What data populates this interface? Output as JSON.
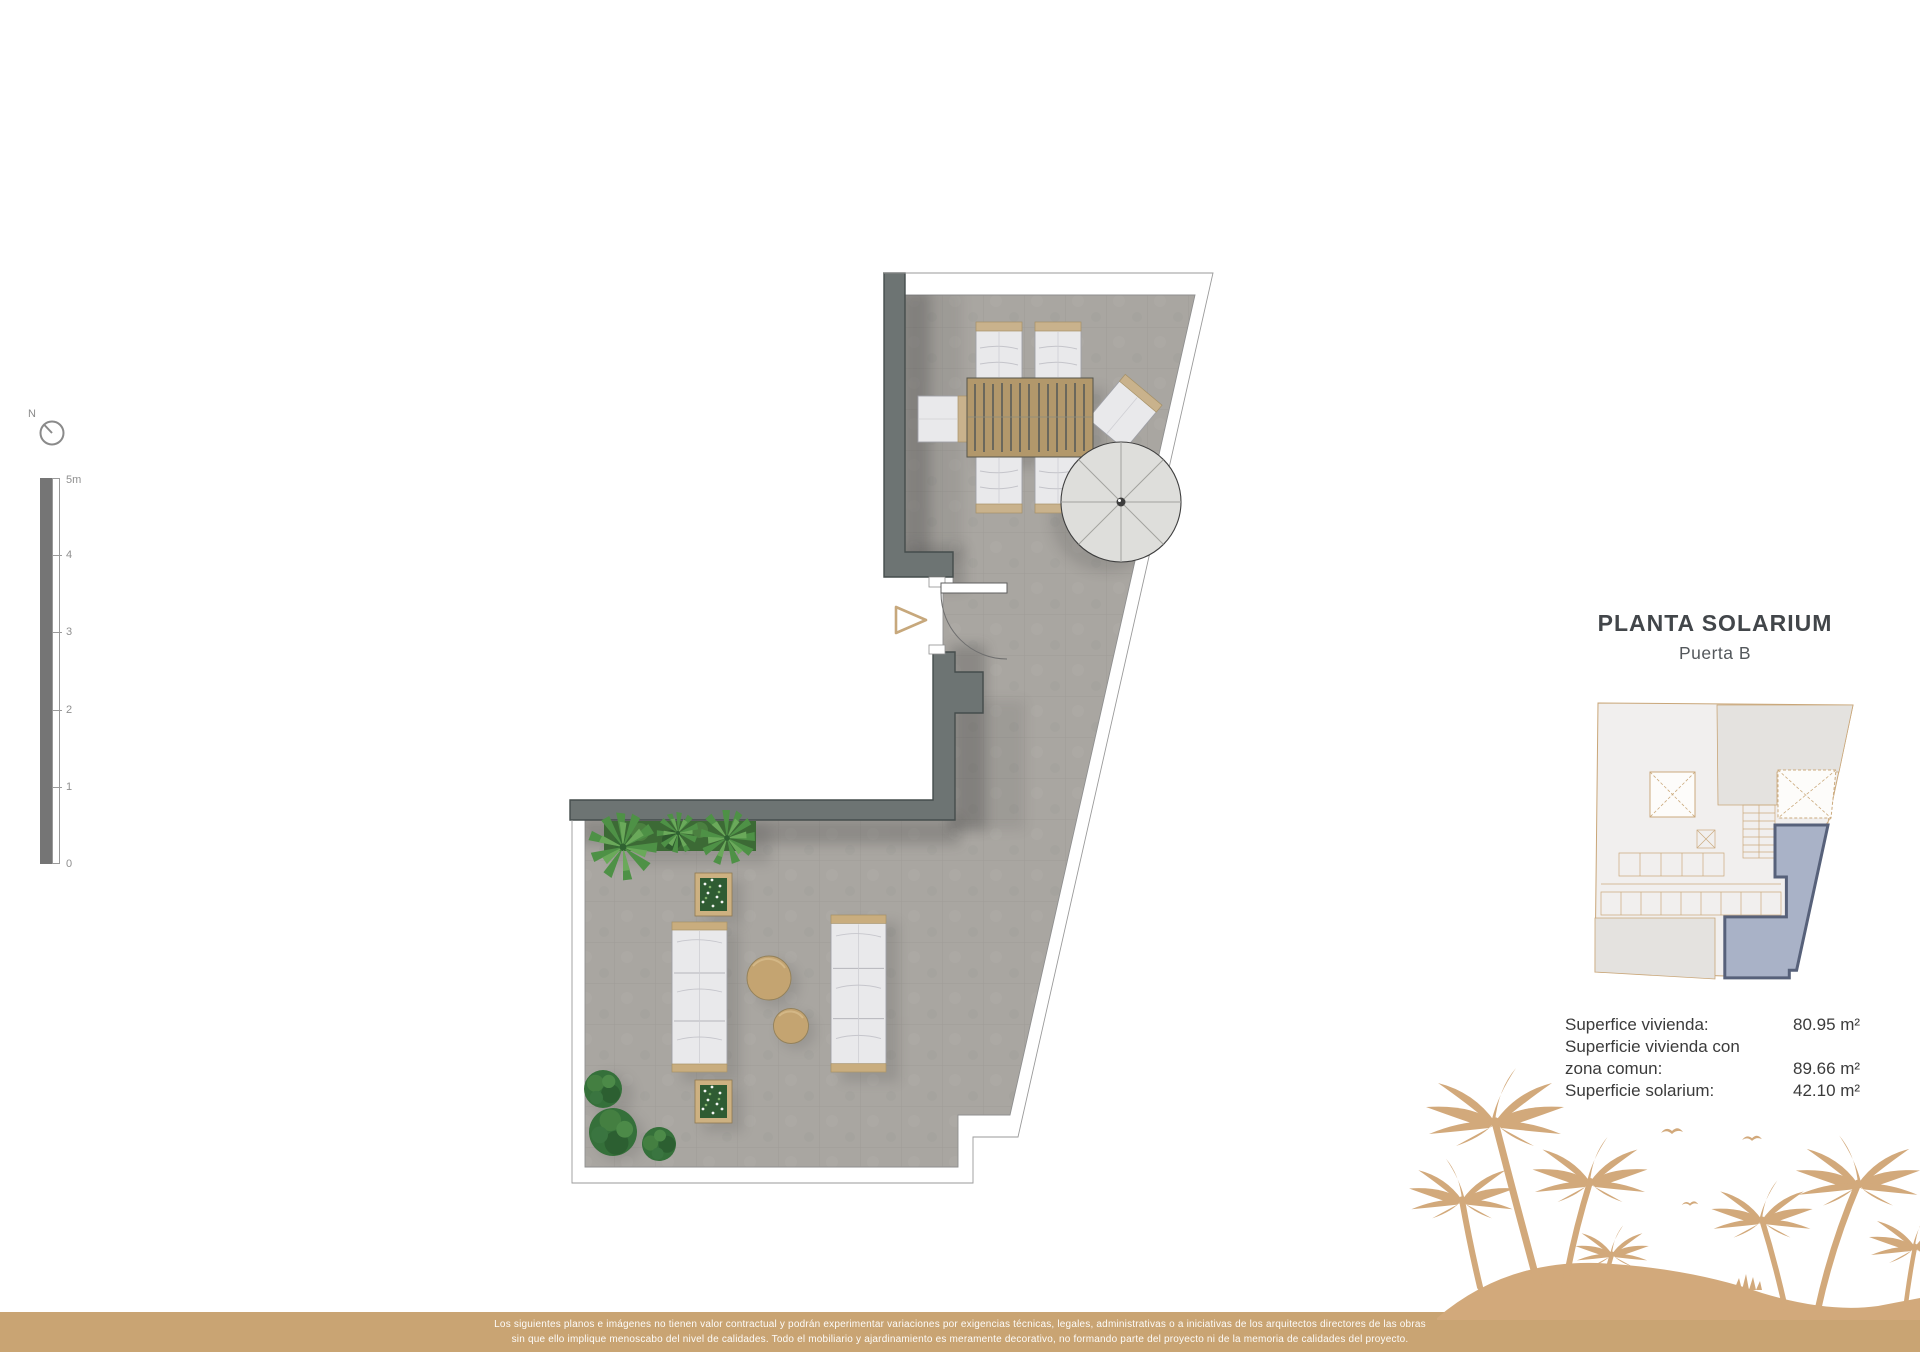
{
  "header": {
    "title": "PLANTA SOLARIUM",
    "subtitle": "Puerta B"
  },
  "areas": {
    "rows": [
      {
        "label": "Superfice vivienda:",
        "value": "80.95 m²"
      },
      {
        "label": "Superficie vivienda con zona comun:",
        "value": "89.66 m²"
      },
      {
        "label": "Superficie solarium:",
        "value": "42.10 m²"
      }
    ]
  },
  "scale_bar": {
    "top_label": "5m",
    "ticks": [
      "4",
      "3",
      "2",
      "1"
    ],
    "zero_label": "0"
  },
  "compass": {
    "label": "N"
  },
  "disclaimer": {
    "line1": "Los siguientes planos e imágenes no tienen valor contractual y podrán experimentar variaciones por exigencias técnicas, legales, administrativas o a iniciativas de los arquitectos directores de las obras",
    "line2": "sin que ello implique menoscabo del nivel de calidades. Todo el mobiliario y ajardinamiento es meramente decorativo, no formando parte del proyecto ni de la memoria de calidades del proyecto."
  },
  "colors": {
    "wall": "#6d7473",
    "floor": "#a9a6a1",
    "wood": "#b2986b",
    "accent_tan": "#c9a473",
    "palm_silhouette": "#d2a97b",
    "keyplan_highlight_fill": "#a9b2c7",
    "keyplan_highlight_border": "#57617a",
    "keyplan_line": "#c9a678"
  }
}
